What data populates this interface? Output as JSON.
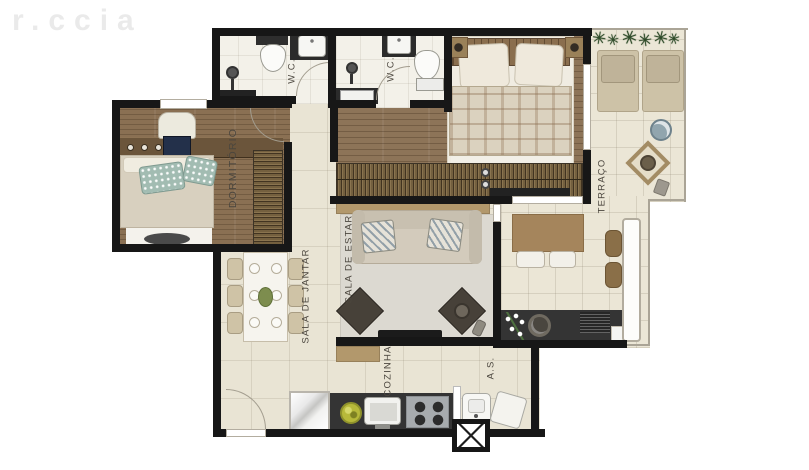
{
  "watermark": {
    "text": "r.ccia"
  },
  "rooms": {
    "dormitorio": {
      "label": "DORMITÓRIO"
    },
    "wc1": {
      "label": "W.C."
    },
    "wc2": {
      "label": "W.C."
    },
    "sala_de_jantar": {
      "label": "SALA DE JANTAR"
    },
    "sala_de_estar": {
      "label": "SALA DE ESTAR"
    },
    "cozinha": {
      "label": "COZINHA"
    },
    "area_de_servico": {
      "label": "A.S."
    },
    "terraco": {
      "label": "TERRAÇO"
    }
  },
  "palette": {
    "wall": "#171717",
    "tile_floor": "#e9e4d4",
    "wc_floor": "#f3f1e9",
    "terrace_floor": "#ebe6d6",
    "wood_floor": "#8d7458",
    "wardrobe_wood": "#74603f",
    "counter_dark": "#343434",
    "accent_tan": "#b2986c",
    "plant_green": "#2d4a28",
    "centerpiece_green": "#7d8d4e"
  }
}
